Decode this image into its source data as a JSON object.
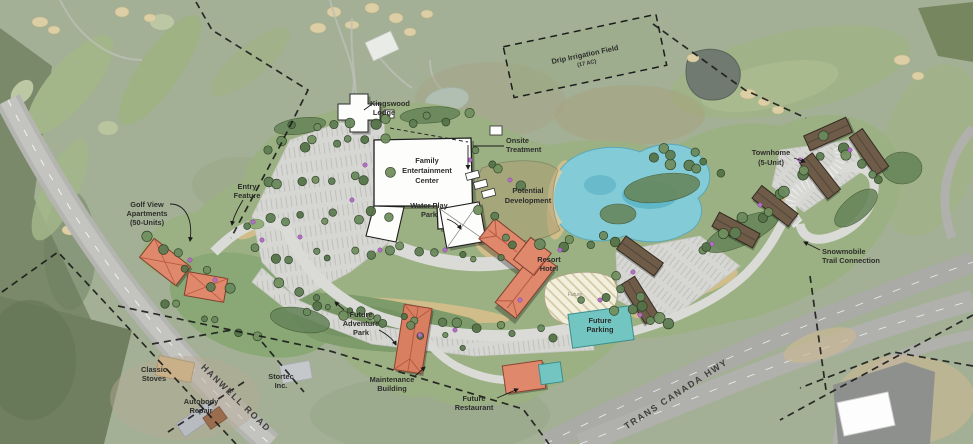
{
  "map_title": "Resort development master plan over aerial photo",
  "labels": {
    "kingswood_lodge": {
      "lines": [
        "Kingswood",
        "Lodge"
      ]
    },
    "family_entertainment": {
      "lines": [
        "Family",
        "Entertainment",
        "Center"
      ]
    },
    "water_play_park": {
      "lines": [
        "Water Play",
        "Park"
      ]
    },
    "onsite_treatment": {
      "lines": [
        "Onsite",
        "Treatment"
      ]
    },
    "potential_development": {
      "lines": [
        "Potential",
        "Development"
      ]
    },
    "drip_irrigation_field": {
      "lines": [
        "Drip Irrigation Field",
        "(17 AC)"
      ]
    },
    "townhome": {
      "lines": [
        "Townhome",
        "(5-Unit)"
      ]
    },
    "snowmobile_trail": {
      "lines": [
        "Snowmobile",
        "Trail Connection"
      ]
    },
    "entry_feature": {
      "lines": [
        "Entry",
        "Feature"
      ]
    },
    "golf_view_apartments": {
      "lines": [
        "Golf View",
        "Apartments",
        "(50-Units)"
      ]
    },
    "resort_hotel": {
      "lines": [
        "Resort",
        "Hotel"
      ]
    },
    "future_parking": {
      "lines": [
        "Future",
        "Parking"
      ]
    },
    "future_area": {
      "lines": [
        "Future"
      ]
    },
    "future_adventure_park": {
      "lines": [
        "Future",
        "Adventure",
        "Park"
      ]
    },
    "maintenance_building": {
      "lines": [
        "Maintenance",
        "Building"
      ]
    },
    "future_restaurant": {
      "lines": [
        "Future",
        "Restaurant"
      ]
    },
    "classic_stoves": {
      "lines": [
        "Classic",
        "Stoves"
      ]
    },
    "stortec": {
      "lines": [
        "Stortec",
        "Inc."
      ]
    },
    "autobody_repair": {
      "lines": [
        "Autobody",
        "Repair"
      ]
    }
  },
  "roads": {
    "hanwell": "HANWELL ROAD",
    "trans_canada": "TRANS CANADA HWY"
  },
  "colors": {
    "pond": "#83cbd6",
    "resort_hotel": "#e0886c",
    "townhome": "#6e5c49",
    "future_parking": "#72c5c1",
    "building_white": "#fdfdfb",
    "landscape_green": "#9cb183",
    "parking_gray": "#d6d7d3"
  }
}
